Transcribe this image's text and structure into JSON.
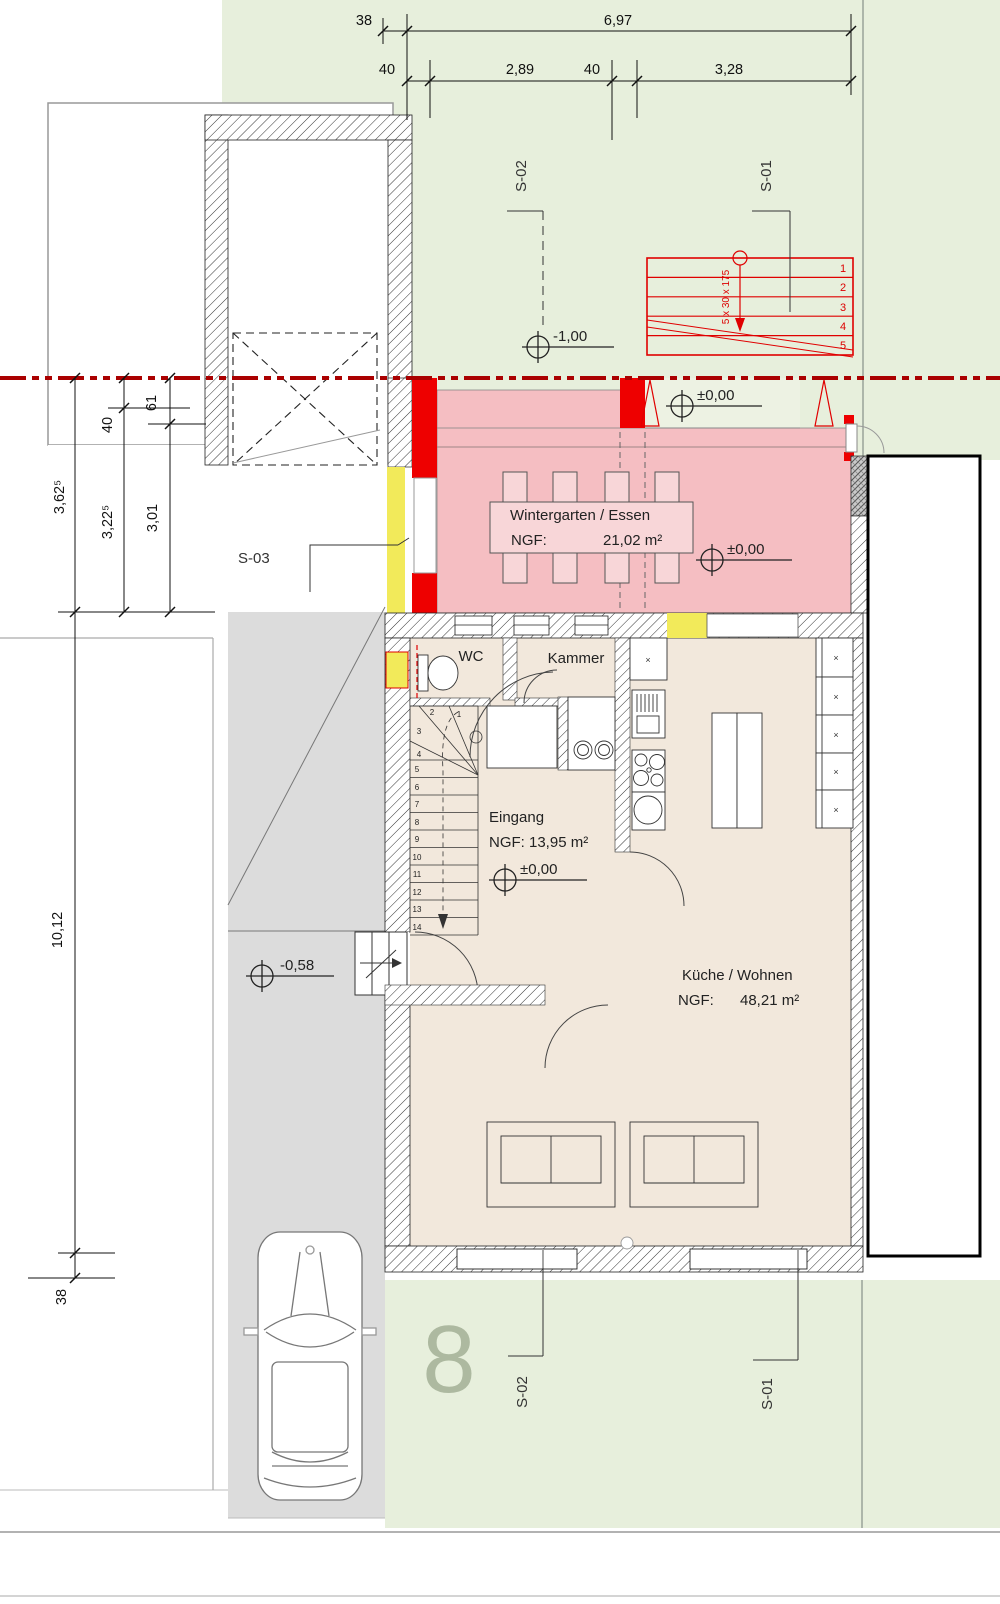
{
  "colors": {
    "garden": "#e7efdc",
    "floor": "#f2e8dc",
    "wintergarten_pink": "#f5bec2",
    "table_pink": "#f8d6d8",
    "new_construction_red": "#ee0000",
    "boundary_line_red": "#aa0000",
    "demolition_yellow": "#f2ea5a",
    "driveway_gray": "#dcdcdc",
    "house_number_green": "#a3b096"
  },
  "dims": {
    "top38": "38",
    "top697": "6,97",
    "top40a": "40",
    "top289": "2,89",
    "top40b": "40",
    "top328": "3,28",
    "left40": "40",
    "left61": "61",
    "left3625": "3,62⁵",
    "left3225": "3,22⁵",
    "left301": "3,01",
    "left1012": "10,12",
    "left38": "38"
  },
  "levels": {
    "minus100": "-1,00",
    "zero": "±0,00",
    "minus058": "-0,58"
  },
  "sections": {
    "s01": "S-01",
    "s02": "S-02",
    "s03": "S-03"
  },
  "rooms": {
    "wintergarten": {
      "name": "Wintergarten / Essen",
      "ngf_label": "NGF:",
      "area": "21,02 m²"
    },
    "wc": {
      "name": "WC"
    },
    "kammer": {
      "name": "Kammer"
    },
    "eingang": {
      "name": "Eingang",
      "ngf": "NGF: 13,95 m²"
    },
    "kueche": {
      "name": "Küche / Wohnen",
      "ngf_label": "NGF:",
      "area": "48,21 m²"
    }
  },
  "outdoor_stair": {
    "note": "5 x 30 x 175",
    "steps": [
      "1",
      "2",
      "3",
      "4",
      "5"
    ]
  },
  "indoor_stair": {
    "steps": [
      "1",
      "2",
      "3",
      "4",
      "5",
      "6",
      "7",
      "8",
      "9",
      "10",
      "11",
      "12",
      "13",
      "14"
    ]
  },
  "house_number": "8"
}
